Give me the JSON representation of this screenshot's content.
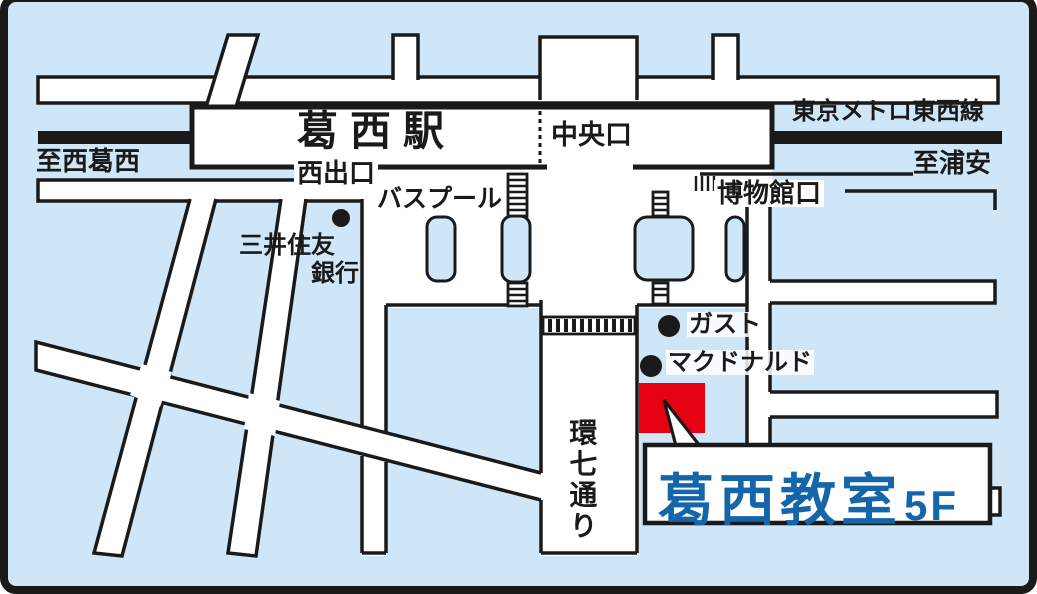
{
  "map": {
    "colors": {
      "background": "#cee6f7",
      "road": "#ffffff",
      "line": "#1a1a1a",
      "destination_red": "#e50012",
      "classroom_blue": "#1565ab"
    },
    "labels": {
      "station": "葛西駅",
      "chuo_exit": "中央口",
      "tozai_line": "東京メトロ東西線",
      "to_nishikasai": "至西葛西",
      "to_urayasu": "至浦安",
      "nishi_exit": "西出口",
      "bus_pool": "バスプール",
      "museum_exit": "博物館口",
      "bank_line1": "三井住友",
      "bank_line2": "銀行",
      "gusto": "ガスト",
      "mcdonalds": "マクドナルド",
      "kannana_street": "環七通り",
      "classroom_name": "葛西教室",
      "classroom_floor": "5F"
    }
  }
}
